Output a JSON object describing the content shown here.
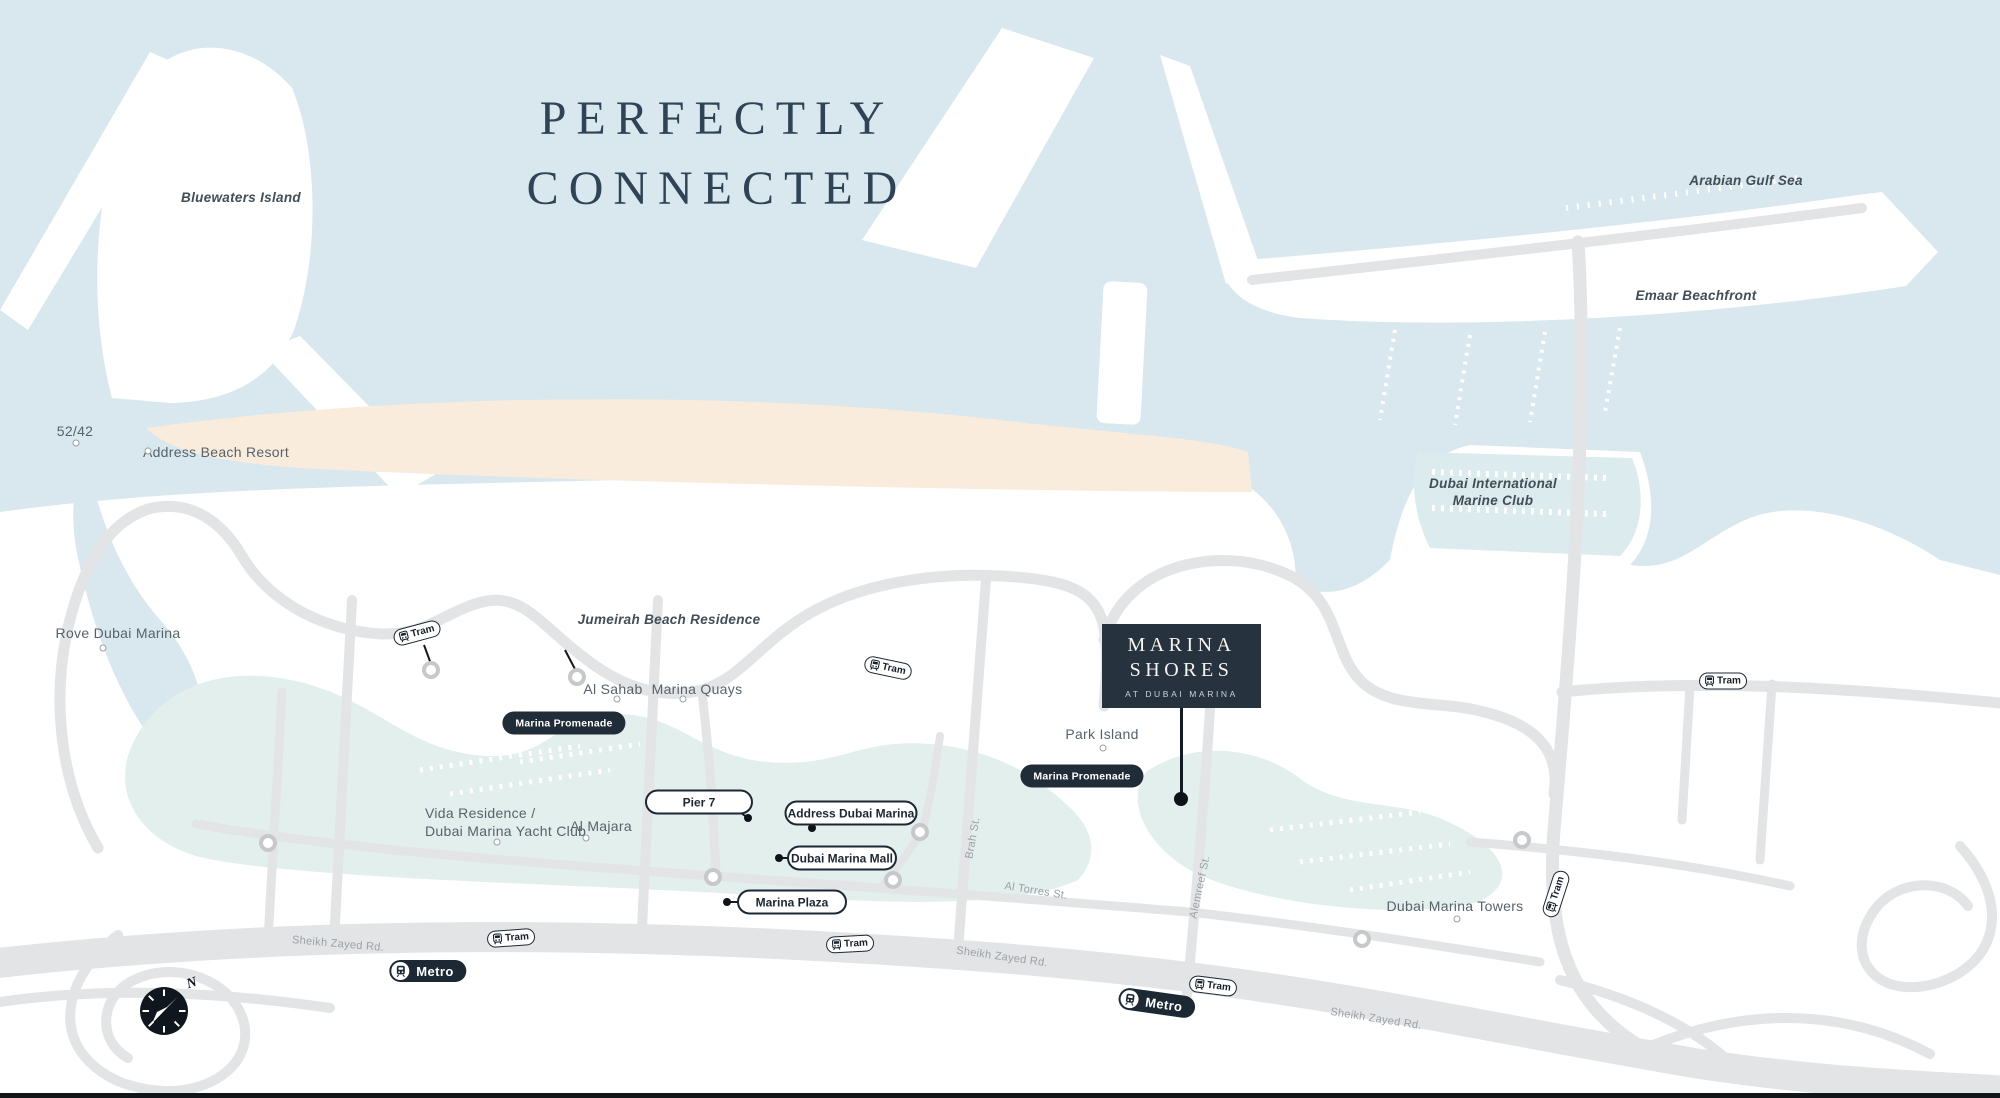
{
  "title": {
    "line1": "PERFECTLY",
    "line2": "CONNECTED"
  },
  "colors": {
    "sea": "#d9e8ee",
    "lagoon": "#e2efec",
    "sand": "#f9ecdd",
    "land": "#ffffff",
    "road": "#e3e4e6",
    "navy": "#222f3c",
    "label": "#57626b",
    "road_label": "#9aa1a7",
    "title": "#2e4355"
  },
  "map": {
    "place_labels": [
      {
        "id": "bluewaters-island",
        "lines": [
          "Bluewaters Island"
        ],
        "x": 241,
        "y": 190,
        "style": "italic"
      },
      {
        "id": "52-42",
        "lines": [
          "52/42"
        ],
        "x": 75,
        "y": 423,
        "style": "plain",
        "marker": {
          "x": 76,
          "y": 443
        }
      },
      {
        "id": "address-beach-resort",
        "lines": [
          "Address Beach Resort"
        ],
        "x": 216,
        "y": 444,
        "style": "plain",
        "marker": {
          "x": 148,
          "y": 451
        }
      },
      {
        "id": "arabian-gulf-sea",
        "lines": [
          "Arabian Gulf Sea"
        ],
        "x": 1746,
        "y": 173,
        "style": "italic"
      },
      {
        "id": "emaar-beachfront",
        "lines": [
          "Emaar Beachfront"
        ],
        "x": 1696,
        "y": 288,
        "style": "italic"
      },
      {
        "id": "dubai-international-marine-club",
        "lines": [
          "Dubai International",
          "Marine Club"
        ],
        "x": 1493,
        "y": 476,
        "style": "italic"
      },
      {
        "id": "rove-dubai-marina",
        "lines": [
          "Rove Dubai Marina"
        ],
        "x": 118,
        "y": 625,
        "style": "plain",
        "marker": {
          "x": 103,
          "y": 648
        }
      },
      {
        "id": "jumeirah-beach-residence",
        "lines": [
          "Jumeirah Beach Residence"
        ],
        "x": 669,
        "y": 612,
        "style": "italic"
      },
      {
        "id": "al-sahab",
        "lines": [
          "Al Sahab"
        ],
        "x": 613,
        "y": 681,
        "style": "plain",
        "marker": {
          "x": 617,
          "y": 699
        }
      },
      {
        "id": "marina-quays",
        "lines": [
          "Marina Quays"
        ],
        "x": 697,
        "y": 681,
        "style": "plain",
        "marker": {
          "x": 683,
          "y": 699
        }
      },
      {
        "id": "park-island",
        "lines": [
          "Park Island"
        ],
        "x": 1102,
        "y": 726,
        "style": "plain",
        "marker": {
          "x": 1103,
          "y": 748
        }
      },
      {
        "id": "vida-residence-yacht-club",
        "lines": [
          "Vida Residence /",
          "Dubai Marina Yacht Club"
        ],
        "x": 425,
        "y": 805,
        "style": "plain",
        "align": "left",
        "marker": {
          "x": 497,
          "y": 842
        }
      },
      {
        "id": "al-majara",
        "lines": [
          "Al Majara"
        ],
        "x": 601,
        "y": 818,
        "style": "plain",
        "marker": {
          "x": 586,
          "y": 838
        }
      },
      {
        "id": "dubai-marina-towers",
        "lines": [
          "Dubai Marina Towers"
        ],
        "x": 1455,
        "y": 898,
        "style": "plain",
        "marker": {
          "x": 1457,
          "y": 919
        }
      }
    ],
    "road_labels": [
      {
        "text": "Sheikh Zayed Rd.",
        "x": 338,
        "y": 944,
        "rot": 5
      },
      {
        "text": "Sheikh Zayed Rd.",
        "x": 1002,
        "y": 957,
        "rot": 8
      },
      {
        "text": "Sheikh Zayed Rd.",
        "x": 1376,
        "y": 1019,
        "rot": 9
      },
      {
        "text": "Al Torres St.",
        "x": 1036,
        "y": 891,
        "rot": 9
      },
      {
        "text": "Brah St.",
        "x": 973,
        "y": 838,
        "rot": -80
      },
      {
        "text": "Alemreef St.",
        "x": 1200,
        "y": 887,
        "rot": -78
      }
    ],
    "junction_rings": [
      {
        "x": 431,
        "y": 670
      },
      {
        "x": 577,
        "y": 677
      },
      {
        "x": 268,
        "y": 843
      },
      {
        "x": 713,
        "y": 877
      },
      {
        "x": 893,
        "y": 880
      },
      {
        "x": 920,
        "y": 832
      },
      {
        "x": 1362,
        "y": 939
      },
      {
        "x": 1522,
        "y": 840
      }
    ],
    "leader_lines": [
      {
        "x1": 424,
        "y1": 645,
        "x2": 431,
        "y2": 664
      },
      {
        "x1": 565,
        "y1": 650,
        "x2": 576,
        "y2": 671
      }
    ],
    "poi_pills": [
      {
        "id": "pier-7",
        "text": "Pier 7",
        "cx": 699,
        "cy": 802,
        "w": 108,
        "dot": {
          "x": 748,
          "y": 818
        },
        "stub": {
          "x": 737,
          "y": 810
        }
      },
      {
        "id": "address-dubai-marina",
        "text": "Address Dubai Marina",
        "cx": 851,
        "cy": 813,
        "w": 133,
        "dot": {
          "x": 812,
          "y": 828
        },
        "stub": {
          "x": 812,
          "y": 821
        }
      },
      {
        "id": "dubai-marina-mall",
        "text": "Dubai Marina Mall",
        "cx": 842,
        "cy": 858,
        "w": 110,
        "dot": {
          "x": 779,
          "y": 858
        },
        "stub": {
          "x": 789,
          "y": 858
        }
      },
      {
        "id": "marina-plaza",
        "text": "Marina Plaza",
        "cx": 792,
        "cy": 902,
        "w": 110,
        "dot": {
          "x": 727,
          "y": 902
        },
        "stub": {
          "x": 739,
          "y": 902
        }
      }
    ],
    "promenade": {
      "label": "Marina Promenade",
      "positions": [
        {
          "cx": 564,
          "cy": 723
        },
        {
          "cx": 1082,
          "cy": 776
        }
      ]
    },
    "tram": {
      "label": "Tram",
      "stops": [
        {
          "cx": 417,
          "cy": 633,
          "rot": -15
        },
        {
          "cx": 888,
          "cy": 668,
          "rot": 12
        },
        {
          "cx": 1723,
          "cy": 681,
          "rot": 0
        },
        {
          "cx": 511,
          "cy": 938,
          "rot": -4
        },
        {
          "cx": 850,
          "cy": 944,
          "rot": -3
        },
        {
          "cx": 1213,
          "cy": 986,
          "rot": 7
        },
        {
          "cx": 1556,
          "cy": 894,
          "rot": -72
        }
      ]
    },
    "metro": {
      "label": "Metro",
      "stops": [
        {
          "cx": 428,
          "cy": 971,
          "rot": 0
        },
        {
          "cx": 1157,
          "cy": 1003,
          "rot": 8
        }
      ]
    },
    "project_card": {
      "title_line1": "MARINA",
      "title_line2": "SHORES",
      "subtitle": "AT DUBAI MARINA"
    },
    "compass": {
      "label": "N"
    }
  }
}
